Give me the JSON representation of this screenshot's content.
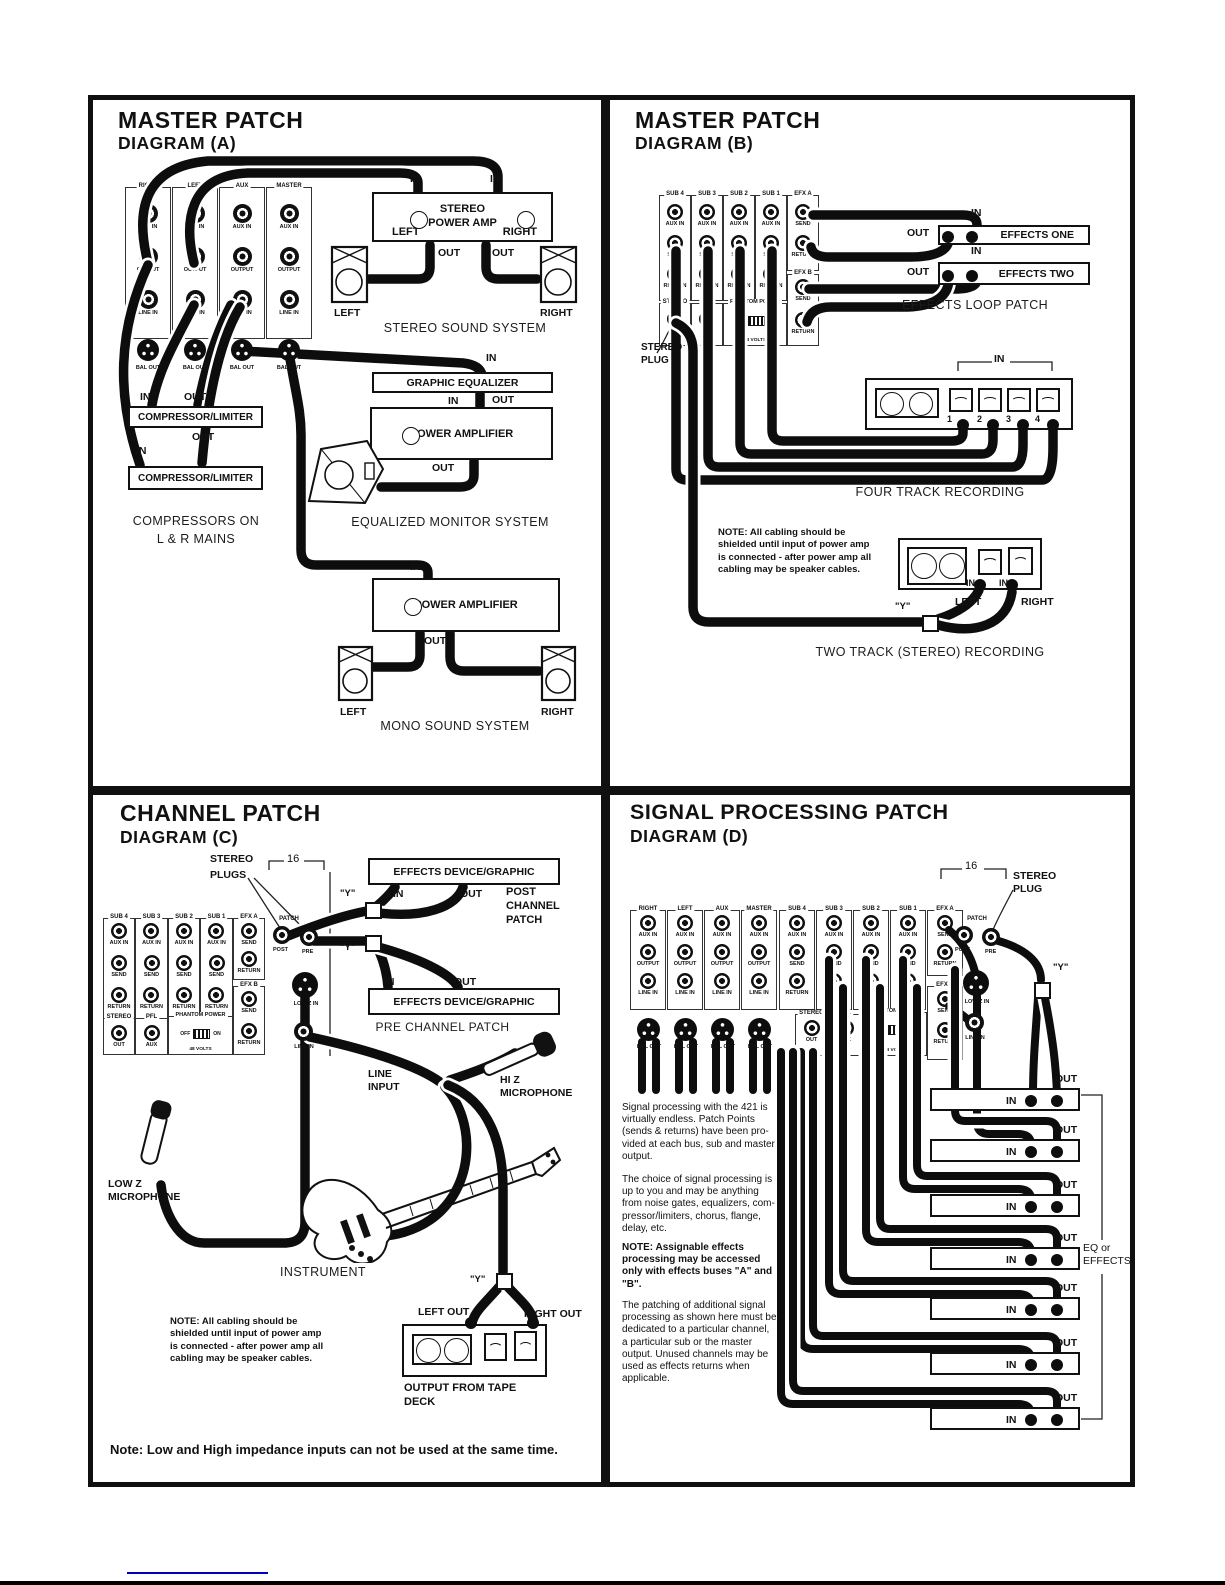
{
  "io": {
    "in": "IN",
    "out": "OUT"
  },
  "note_cabling": [
    "NOTE: All cabling should be",
    "shielded until input of power amp",
    "is connected - after power amp all",
    "cabling may be speaker cables."
  ],
  "sub": {
    "cols": [
      {
        "h": "SUB 4"
      },
      {
        "h": "SUB 3"
      },
      {
        "h": "SUB 2"
      },
      {
        "h": "SUB 1"
      }
    ],
    "rows": [
      "AUX IN",
      "SEND",
      "RETURN"
    ],
    "efxa": {
      "h": "EFX A",
      "r1": "SEND",
      "r2": "RETURN"
    },
    "efxb": {
      "h": "EFX B",
      "r1": "SEND",
      "r2": "RETURN"
    },
    "stereo": {
      "h": "STEREO",
      "j": "OUT"
    },
    "pfl": {
      "h": "PFL",
      "j": "AUX"
    },
    "phantom": {
      "h": "PHANTOM POWER",
      "off": "OFF",
      "on": "ON",
      "v": "48 VOLTS"
    },
    "patch": {
      "h": "PATCH",
      "post": "POST",
      "pre": "PRE"
    },
    "lowz": "LOW Z IN",
    "linein": "LINE IN"
  },
  "a": {
    "title": "MASTER PATCH",
    "subtitle": "DIAGRAM (A)",
    "cols": [
      {
        "h": "RIGHT"
      },
      {
        "h": "LEFT"
      },
      {
        "h": "AUX"
      },
      {
        "h": "MASTER"
      }
    ],
    "rows": [
      "AUX IN",
      "OUTPUT",
      "LINE IN"
    ],
    "xlr": "BAL OUT",
    "amp": {
      "l1": "STEREO",
      "l2": "POWER AMP",
      "left": "LEFT",
      "right": "RIGHT"
    },
    "spk_left": "LEFT",
    "spk_right": "RIGHT",
    "cap_stereo": "STEREO SOUND SYSTEM",
    "geq": "GRAPHIC EQUALIZER",
    "pamp": "POWER AMPLIFIER",
    "comp": "COMPRESSOR/LIMITER",
    "cap_comp1": "COMPRESSORS ON",
    "cap_comp2": "L & R MAINS",
    "cap_eqmon": "EQUALIZED MONITOR SYSTEM",
    "cap_mono": "MONO SOUND SYSTEM"
  },
  "b": {
    "title": "MASTER PATCH",
    "subtitle": "DIAGRAM (B)",
    "plug1": "STEREO",
    "plug2": "PLUG",
    "fx1": "EFFECTS ONE",
    "fx2": "EFFECTS TWO",
    "cap_loop": "EFFECTS LOOP PATCH",
    "tracks": [
      "1",
      "2",
      "3",
      "4"
    ],
    "cap_four": "FOUR TRACK RECORDING",
    "y": "\"Y\"",
    "left": "LEFT",
    "right": "RIGHT",
    "cap_two": "TWO TRACK (STEREO) RECORDING"
  },
  "c": {
    "title": "CHANNEL PATCH",
    "subtitle": "DIAGRAM (C)",
    "plugs1": "STEREO",
    "plugs2": "PLUGS",
    "ch": "16",
    "fxbox": "EFFECTS DEVICE/GRAPHIC",
    "post1": "POST",
    "post2": "CHANNEL",
    "post3": "PATCH",
    "cap_pre": "PRE CHANNEL PATCH",
    "li1": "LINE",
    "li2": "INPUT",
    "hiz1": "HI Z",
    "hiz2": "MICROPHONE",
    "lowz1": "LOW Z",
    "lowz2": "MICROPHONE",
    "instrument": "INSTRUMENT",
    "y": "\"Y\"",
    "left_out": "LEFT OUT",
    "right_out": "RIGHT OUT",
    "deck1": "OUTPUT FROM TAPE",
    "deck2": "DECK",
    "bottom": "Note: Low and High impedance inputs can not be used at the same time."
  },
  "d": {
    "title": "SIGNAL PROCESSING PATCH",
    "subtitle": "DIAGRAM (D)",
    "ch": "16",
    "plug1": "STEREO",
    "plug2": "PLUG",
    "cols": [
      {
        "h": "RIGHT"
      },
      {
        "h": "LEFT"
      },
      {
        "h": "AUX"
      },
      {
        "h": "MASTER"
      }
    ],
    "rows": [
      "AUX IN",
      "OUTPUT",
      "LINE IN"
    ],
    "xlr": "BAL OUT",
    "y": "\"Y\"",
    "eq1": "EQ or",
    "eq2": "EFFECTS",
    "p1": [
      "Signal processing with the 421 is",
      "virtually endless.  Patch Points",
      "(sends & returns) have been pro-",
      "vided at each bus, sub and master",
      "output."
    ],
    "p2": [
      "The choice of signal processing is",
      "up to you and may be anything",
      "from noise gates, equalizers, com-",
      "pressor/limiters, chorus, flange,",
      "delay, etc."
    ],
    "p3": [
      "NOTE: Assignable effects",
      "processing may be accessed",
      "only with effects buses \"A\" and",
      "\"B\"."
    ],
    "p4": [
      "The patching of additional signal",
      "processing as shown here must be",
      "dedicated to a particular channel,",
      "a particular sub or the master",
      "output.  Unused channels may be",
      "used as effects returns when",
      "applicable."
    ]
  }
}
